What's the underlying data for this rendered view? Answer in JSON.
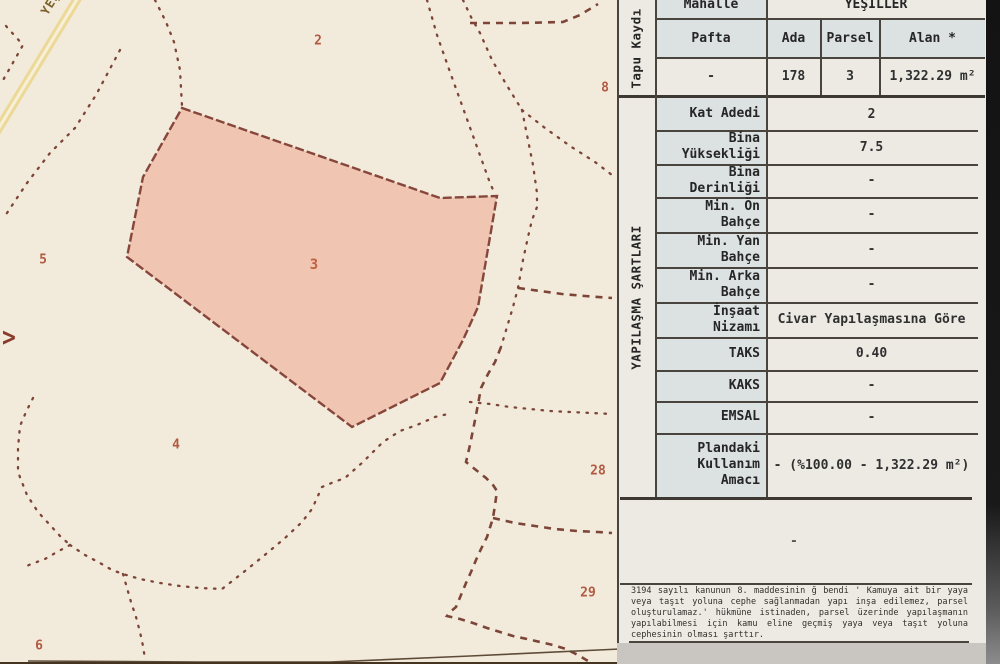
{
  "map": {
    "road_label": "YEŞ",
    "direction_arrow": ">",
    "highlight_color": "#f0c6b2",
    "parcels": [
      {
        "no": "2"
      },
      {
        "no": "8"
      },
      {
        "no": "5"
      },
      {
        "no": "3"
      },
      {
        "no": "4"
      },
      {
        "no": "28"
      },
      {
        "no": "29"
      },
      {
        "no": "6"
      }
    ]
  },
  "table": {
    "tapu": {
      "section_label": "Tapu Kaydı",
      "mahalle": {
        "label": "Mahalle",
        "value": "YEŞİLLER"
      },
      "columns": [
        {
          "header": "Pafta",
          "value": "-"
        },
        {
          "header": "Ada",
          "value": "178"
        },
        {
          "header": "Parsel",
          "value": "3"
        },
        {
          "header": "Alan *",
          "value": "1,322.29 m²"
        }
      ]
    },
    "sartlar": {
      "section_label": "YAPILAŞMA ŞARTLARI",
      "rows": [
        {
          "label": "Kat Adedi",
          "value": "2"
        },
        {
          "label": "Bina\nYüksekliği",
          "value": "7.5"
        },
        {
          "label": "Bina\nDerinliği",
          "value": "-"
        },
        {
          "label": "Min. Ön\nBahçe",
          "value": "-"
        },
        {
          "label": "Min. Yan\nBahçe",
          "value": "-"
        },
        {
          "label": "Min. Arka\nBahçe",
          "value": "-"
        },
        {
          "label": "İnşaat\nNizamı",
          "value": "Civar Yapılaşmasına Göre"
        },
        {
          "label": "TAKS",
          "value": "0.40"
        },
        {
          "label": "KAKS",
          "value": "-"
        },
        {
          "label": "EMSAL",
          "value": "-"
        },
        {
          "label": "Plandaki\nKullanım\nAmacı",
          "value": "- (%100.00 - 1,322.29 m²)"
        }
      ]
    },
    "empty_row_value": "-",
    "note": "3194 sayılı kanunun 8. maddesinin ğ bendi ' Kamuya ait bir yaya veya taşıt yoluna cephe sağlanmadan yapı inşa edilemez, parsel oluşturulamaz.' hükmüne istinaden, parsel üzerinde yapılaşmanın yapılabilmesi için kamu eline geçmiş yaya veya taşıt yoluna cephesinin olması şarttır."
  }
}
